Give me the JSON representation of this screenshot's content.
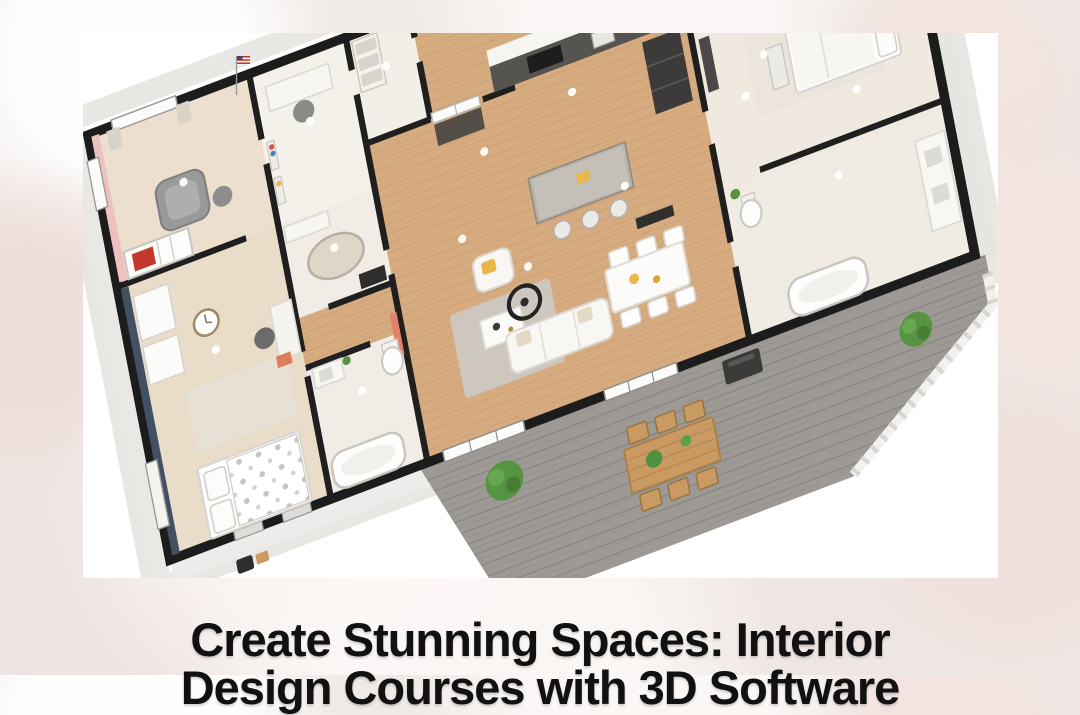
{
  "poster": {
    "headline_line1": "Create Stunning Spaces: Interior",
    "headline_line2": "Design Courses with 3D Software",
    "headline_color": "#111111"
  },
  "image": {
    "kind": "3d-floor-plan-render",
    "rooms": [
      "nursery",
      "home-office",
      "laundry",
      "kitchen",
      "living-room",
      "dining-area",
      "bedroom-left",
      "bathroom",
      "ensuite-bathroom",
      "bedroom-right",
      "hallway",
      "deck"
    ],
    "colors": {
      "card_background": "#ffffff",
      "wall_black": "#1c1c1c",
      "wood_floor": "#d6ab7f",
      "light_room_floor": "#f2eee8",
      "deck_gray": "#9d9994",
      "nursery_pink_wall": "#eec1c1",
      "bedroom_navy_wall": "#415063",
      "plant_green": "#579441",
      "outdoor_wood": "#c99a62",
      "accent_yellow": "#e8b84b",
      "accent_salmon": "#e0836a"
    }
  }
}
